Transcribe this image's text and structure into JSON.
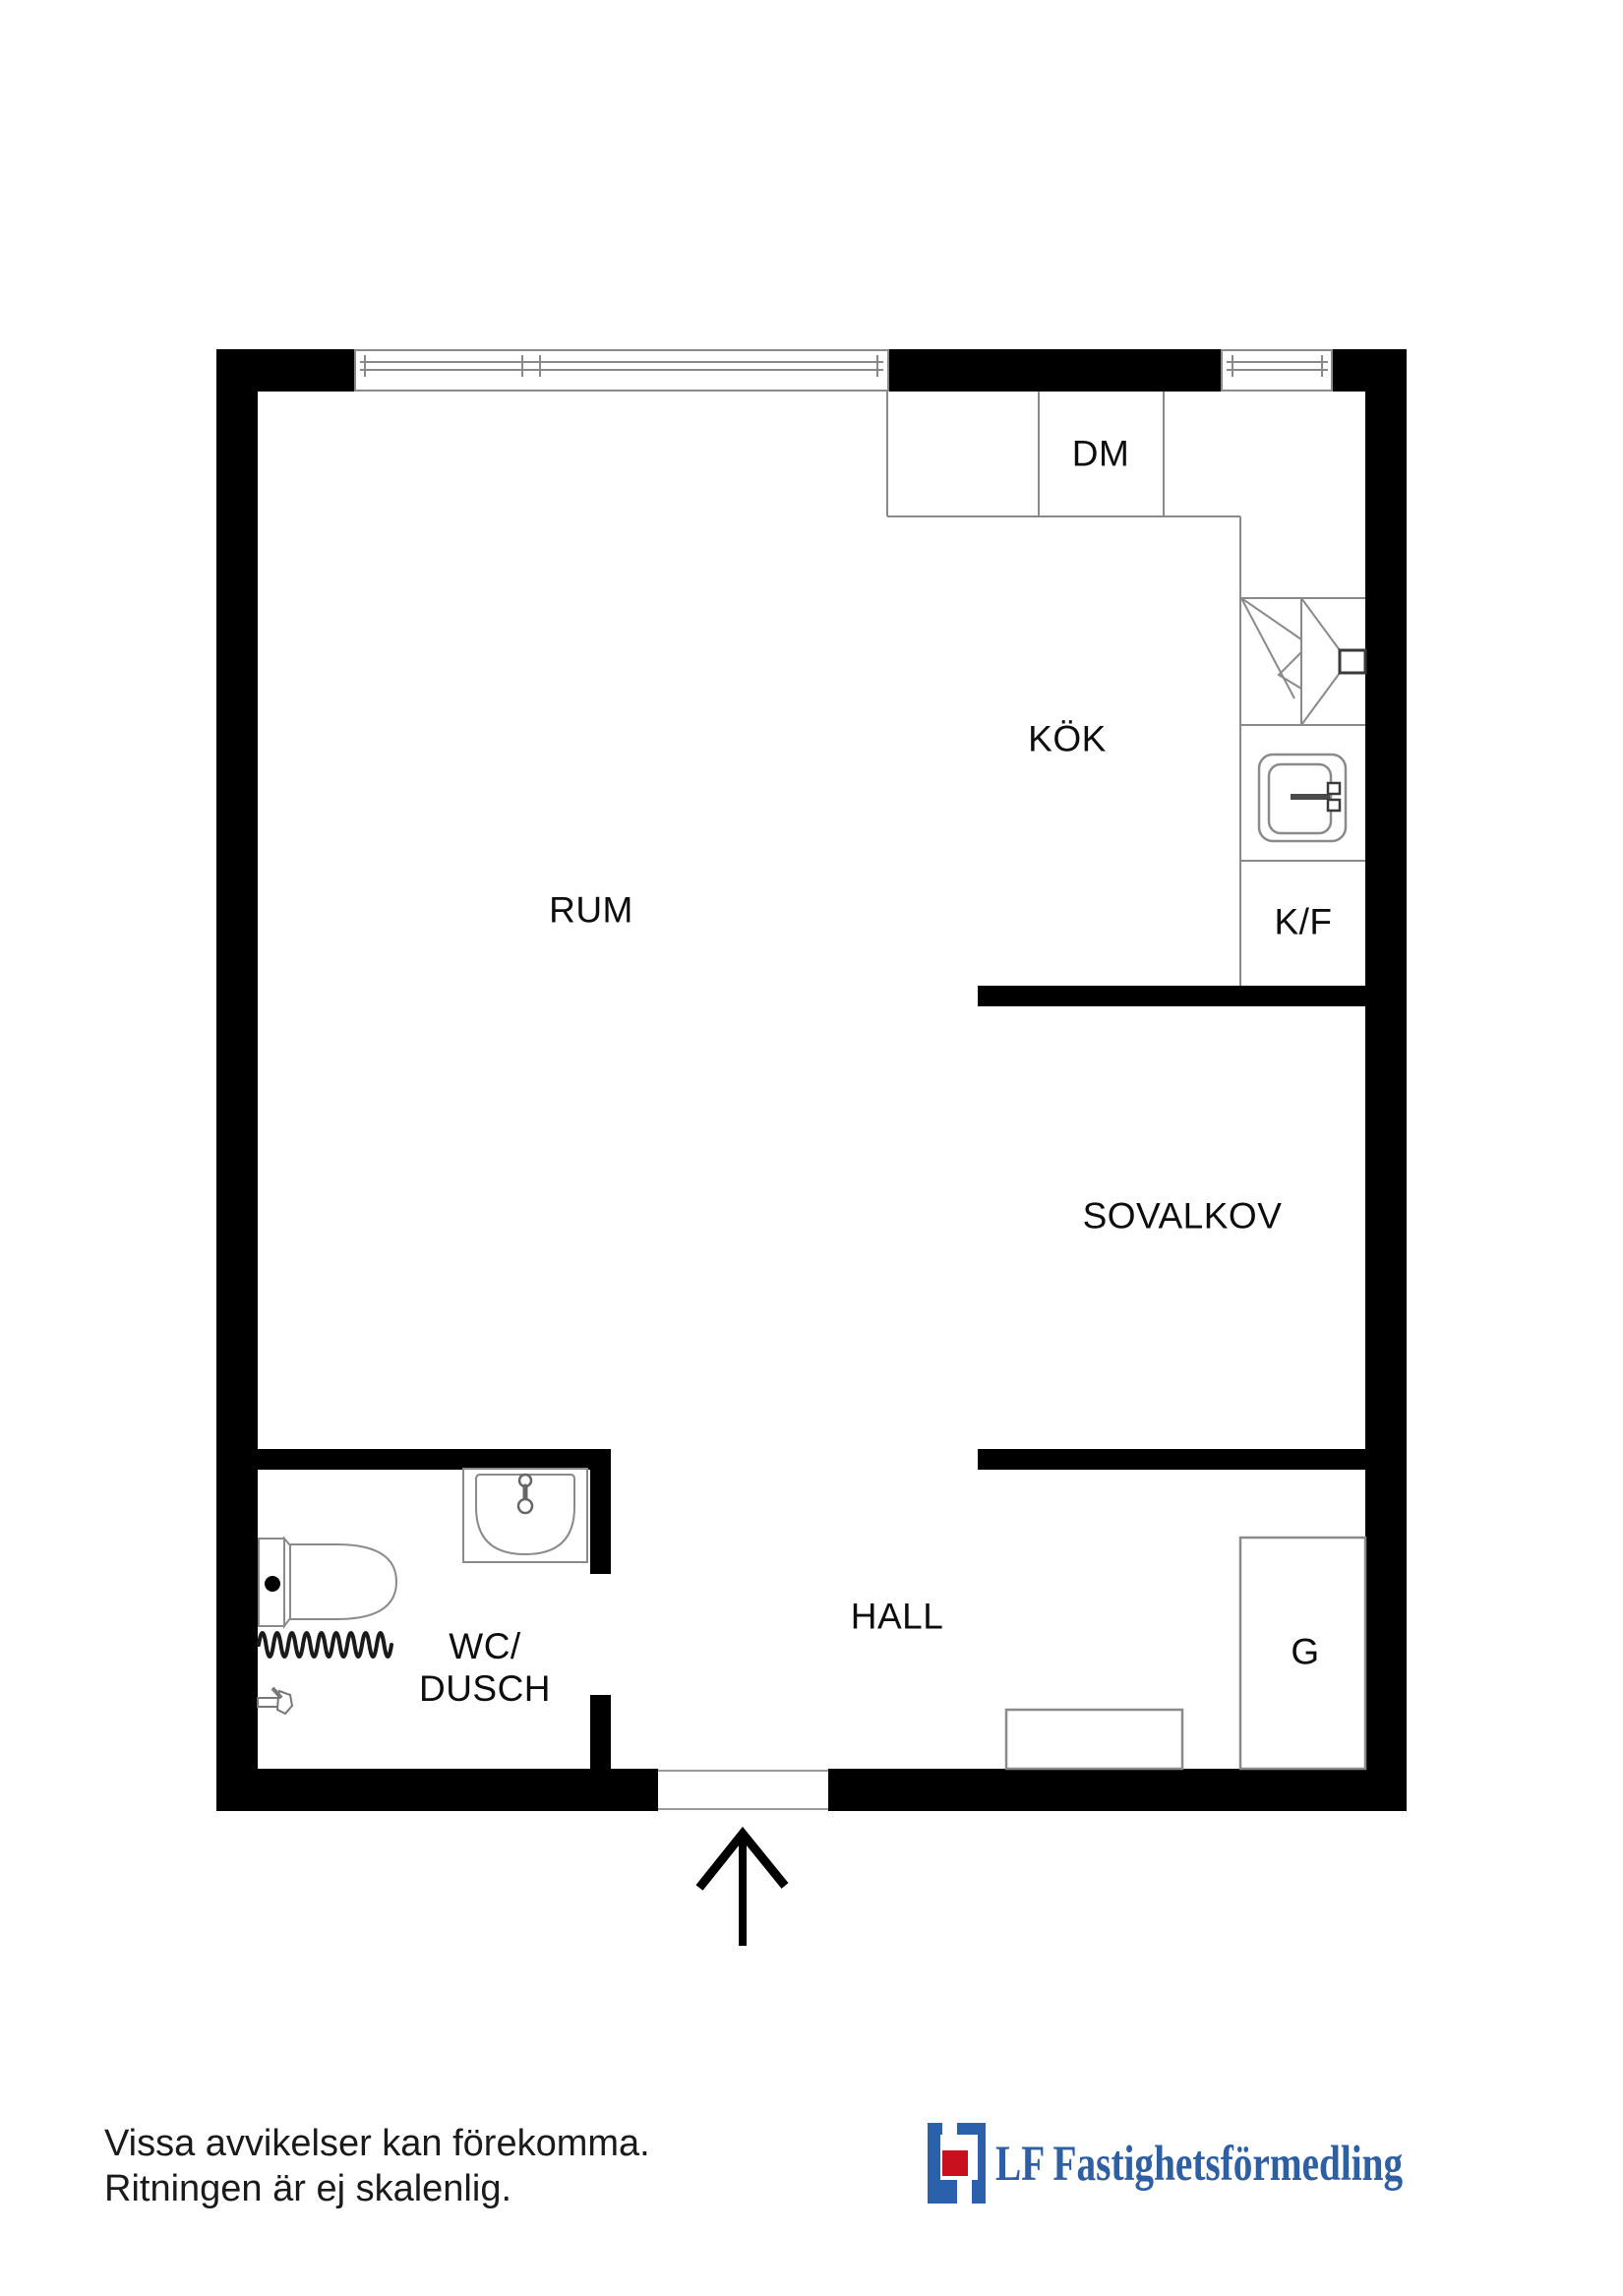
{
  "labels": {
    "dm": "DM",
    "kok": "KÖK",
    "rum": "RUM",
    "kf": "K/F",
    "wc_line1": "WC/",
    "wc_line2": "DUSCH",
    "sovalkov": "SOVALKOV",
    "hall": "HALL",
    "g": "G"
  },
  "footer": {
    "disclaimer_line1": "Vissa avvikelser kan förekomma.",
    "disclaimer_line2": "Ritningen är ej skalenlig.",
    "brand": "LF Fastighetsförmedling"
  },
  "colors": {
    "wall": "#000000",
    "thin_line": "#8a8a8a",
    "logo_blue": "#2b60aa",
    "logo_red": "#c8101e",
    "brand_text": "#2f5fa3"
  }
}
